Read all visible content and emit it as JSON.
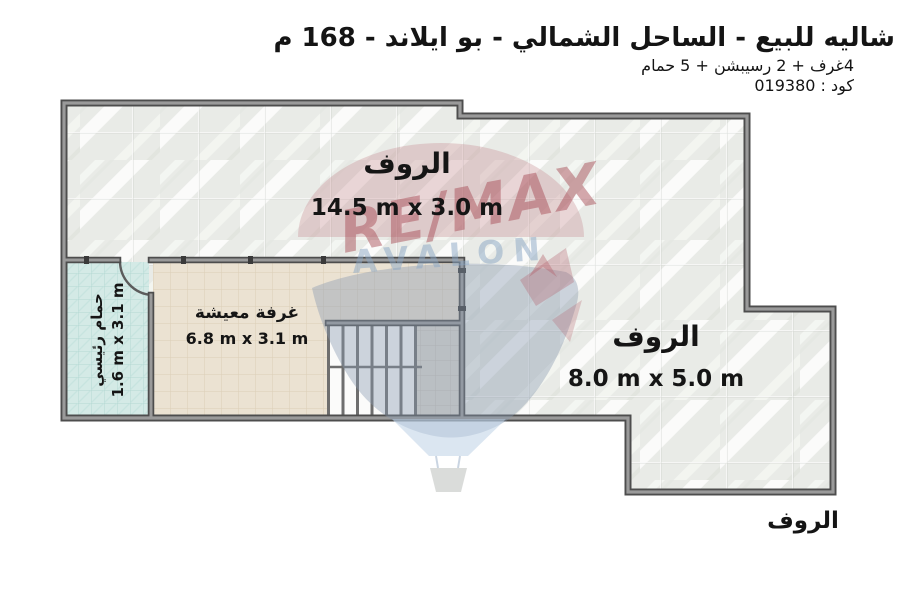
{
  "header": {
    "title": "شاليه للبيع - الساحل الشمالي - بو ايلاند - 168 م",
    "subtitle": "4غرف + 2 رسيبشن + 5 حمام",
    "code": "كود : 019380"
  },
  "floor_plan": {
    "rooms": {
      "roof_top": {
        "name": "الروف",
        "dims": "14.5 m x 3.0 m"
      },
      "roof_right": {
        "name": "الروف",
        "dims": "8.0 m x 5.0 m"
      },
      "living": {
        "name": "غرفة معيشة",
        "dims": "6.8 m x 3.1 m"
      },
      "bathroom": {
        "name": "حمام رئيسي",
        "dims": "1.6 m x 3.1 m"
      },
      "roof_label_outside": {
        "name": "الروف"
      }
    }
  },
  "watermark": {
    "brand": "RE/MAX",
    "agency": "AVALON"
  },
  "colors": {
    "wall_dark": "#4d4d4d",
    "wall_light": "#9a9a9a",
    "marble": "#e9ebe7",
    "living_floor": "#ebe2d2",
    "bathroom_floor": "#d4eae6",
    "landing_floor": "#dcd9d0",
    "watermark_red": "#a84b55",
    "watermark_blue": "#8799af",
    "text": "#141414"
  }
}
